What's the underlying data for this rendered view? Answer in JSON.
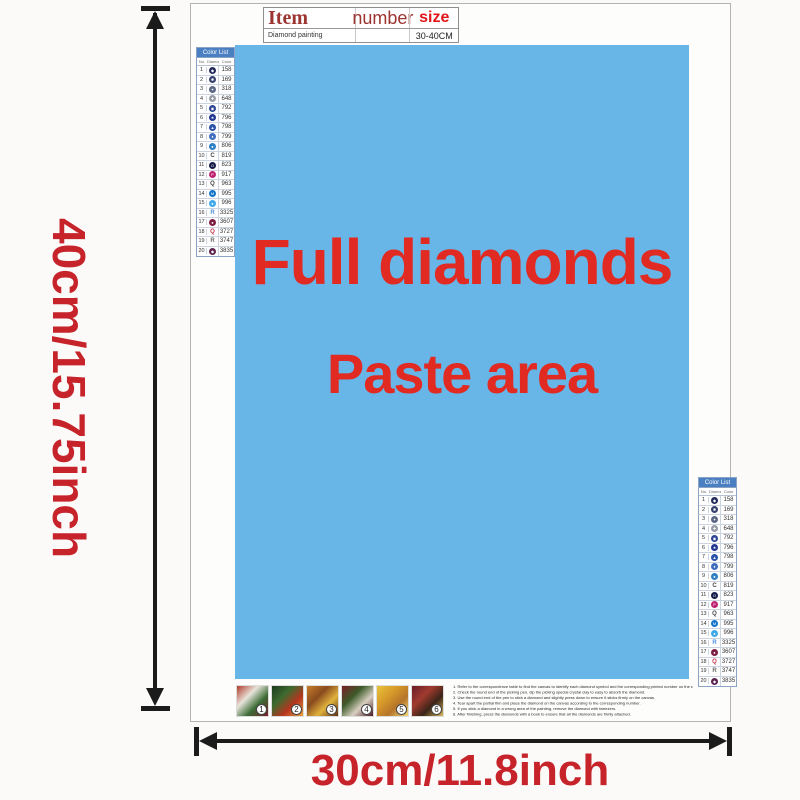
{
  "dim_labels": {
    "height": "40cm/15.75inch",
    "width": "30cm/11.8inch",
    "color": "#c6232b"
  },
  "item_table": {
    "col1": "Item",
    "col2": "number",
    "col3": "size",
    "row_col1": "Diamond painting",
    "row_col2": "",
    "row_col3": "30-40CM"
  },
  "paste_area": {
    "line1": "Full diamonds",
    "line2": "Paste area",
    "bg": "#68b5e8",
    "text_color": "#e12a22"
  },
  "color_list": {
    "title": "Color List",
    "col_no": "No.",
    "col_symbol": "Diamond",
    "col_color": "Color",
    "rows": [
      {
        "no": "1",
        "code": "158",
        "type": "dot",
        "bg": "#232a5c",
        "glyph": "◆"
      },
      {
        "no": "2",
        "code": "169",
        "type": "dot",
        "bg": "#35406e",
        "glyph": "✱"
      },
      {
        "no": "3",
        "code": "318",
        "type": "dot",
        "bg": "#5c6786",
        "glyph": "✦"
      },
      {
        "no": "4",
        "code": "648",
        "type": "dot",
        "bg": "#979ca6",
        "glyph": "✚"
      },
      {
        "no": "5",
        "code": "792",
        "type": "dot",
        "bg": "#2c4494",
        "glyph": "◉"
      },
      {
        "no": "6",
        "code": "796",
        "type": "dot",
        "bg": "#1f3590",
        "glyph": "★"
      },
      {
        "no": "7",
        "code": "798",
        "type": "dot",
        "bg": "#2a52a8",
        "glyph": "▲"
      },
      {
        "no": "8",
        "code": "799",
        "type": "dot",
        "bg": "#3f6cbe",
        "glyph": "♦"
      },
      {
        "no": "9",
        "code": "806",
        "type": "dot",
        "bg": "#2f7fc4",
        "glyph": "●"
      },
      {
        "no": "10",
        "code": "819",
        "type": "letter",
        "text": "C",
        "color": "#444444"
      },
      {
        "no": "11",
        "code": "823",
        "type": "dot",
        "bg": "#131c48",
        "glyph": "O"
      },
      {
        "no": "12",
        "code": "917",
        "type": "dot",
        "bg": "#bf2172",
        "glyph": "P"
      },
      {
        "no": "13",
        "code": "963",
        "type": "letter",
        "text": "Q",
        "color": "#444444"
      },
      {
        "no": "14",
        "code": "995",
        "type": "dot",
        "bg": "#1173c9",
        "glyph": "M"
      },
      {
        "no": "15",
        "code": "996",
        "type": "dot",
        "bg": "#3fa8e8",
        "glyph": "●"
      },
      {
        "no": "16",
        "code": "3325",
        "type": "letter",
        "text": "R",
        "color": "#4a90d9"
      },
      {
        "no": "17",
        "code": "3607",
        "type": "dot",
        "bg": "#7c1f43",
        "glyph": "●"
      },
      {
        "no": "18",
        "code": "3727",
        "type": "letter",
        "text": "Q",
        "color": "#c2344a"
      },
      {
        "no": "19",
        "code": "3747",
        "type": "letter",
        "text": "R",
        "color": "#666666"
      },
      {
        "no": "20",
        "code": "3835",
        "type": "dot",
        "bg": "#5d2350",
        "glyph": "◆"
      }
    ]
  },
  "steps": [
    {
      "number": "1",
      "colors": [
        "#b03a2e",
        "#e8e4da",
        "#3a6b35",
        "#7a1f2b"
      ]
    },
    {
      "number": "2",
      "colors": [
        "#1d3b1f",
        "#3f6b2f",
        "#b5341f",
        "#e8a13c"
      ]
    },
    {
      "number": "3",
      "colors": [
        "#c77f2a",
        "#8a4a1e",
        "#e0b33c",
        "#5d2f14"
      ]
    },
    {
      "number": "4",
      "colors": [
        "#7a1f2b",
        "#3c5a28",
        "#d8cfc0",
        "#4a1520"
      ]
    },
    {
      "number": "5",
      "colors": [
        "#e8c43c",
        "#d89a2a",
        "#b5742a",
        "#f0d878"
      ]
    },
    {
      "number": "6",
      "colors": [
        "#6b1f2a",
        "#a03a2e",
        "#3a2518",
        "#d8b85a"
      ]
    }
  ],
  "instructions": {
    "lines": [
      "1. Refer to the correspondence table to find the canvas to identify each diamond symbol and the corresponding printed number on the canvas.",
      "2. Check the round end of the picking pen, dip the picking special crystal clay to easy to absorb the diamond.",
      "3. Use the round end of the pen to stick a diamond and slightly press down to ensure it sticks firmly on the canvas.",
      "4. Tear apart the partial film and place the diamond on the canvas according to the corresponding number.",
      "5. If you stick a diamond in a wrong area of the painting, remove the diamond with tweezers.",
      "6. After finishing, press the diamonds with a book to ensure that all the diamonds are firmly attached."
    ]
  }
}
